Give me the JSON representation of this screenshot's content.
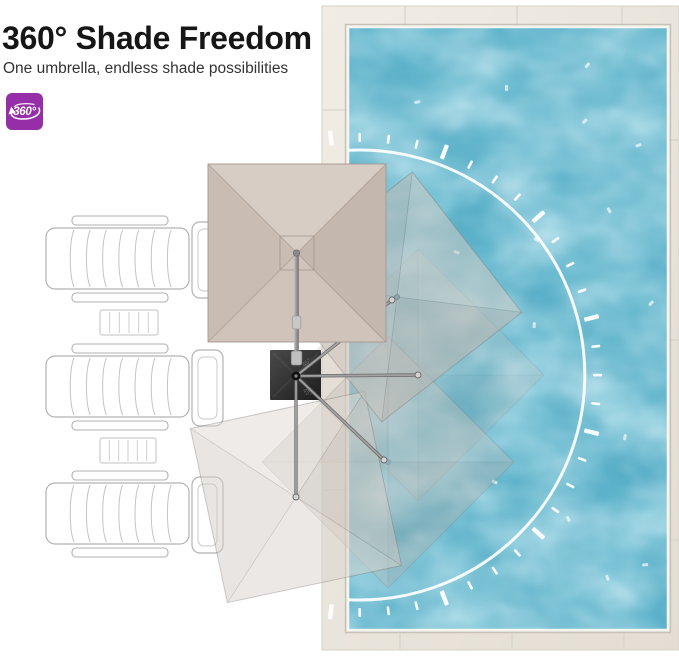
{
  "header": {
    "title": "360° Shade Freedom",
    "subtitle": "One umbrella, endless shade possibilities"
  },
  "badge": {
    "label": "360°",
    "icon": "rotate-360-icon"
  },
  "base_markings": {
    "angle_label": "45°"
  },
  "colors": {
    "accent_purple": "#962fa7",
    "pool_water": "#58aec7",
    "pool_water_light": "#b8e6ef",
    "pool_water_dark": "#2f87a3",
    "deck": "#eae5dd",
    "deck_seam": "#d8d2c7",
    "coping": "#f7f5f0",
    "canopy_top": "#d7cdc4",
    "canopy_right": "#c3b7ae",
    "canopy_bottom": "#cfc3ba",
    "canopy_left": "#c9bcb3",
    "canopy_ridge": "#a39790",
    "ghost_stroke": "#8a827c",
    "umbrella_base": "#2e2e2e",
    "pole_gray": "#9a9a9a",
    "dial_arc": "#ffffff",
    "chair_outline": "#b2b2b2",
    "chair_fill": "#ffffff"
  }
}
